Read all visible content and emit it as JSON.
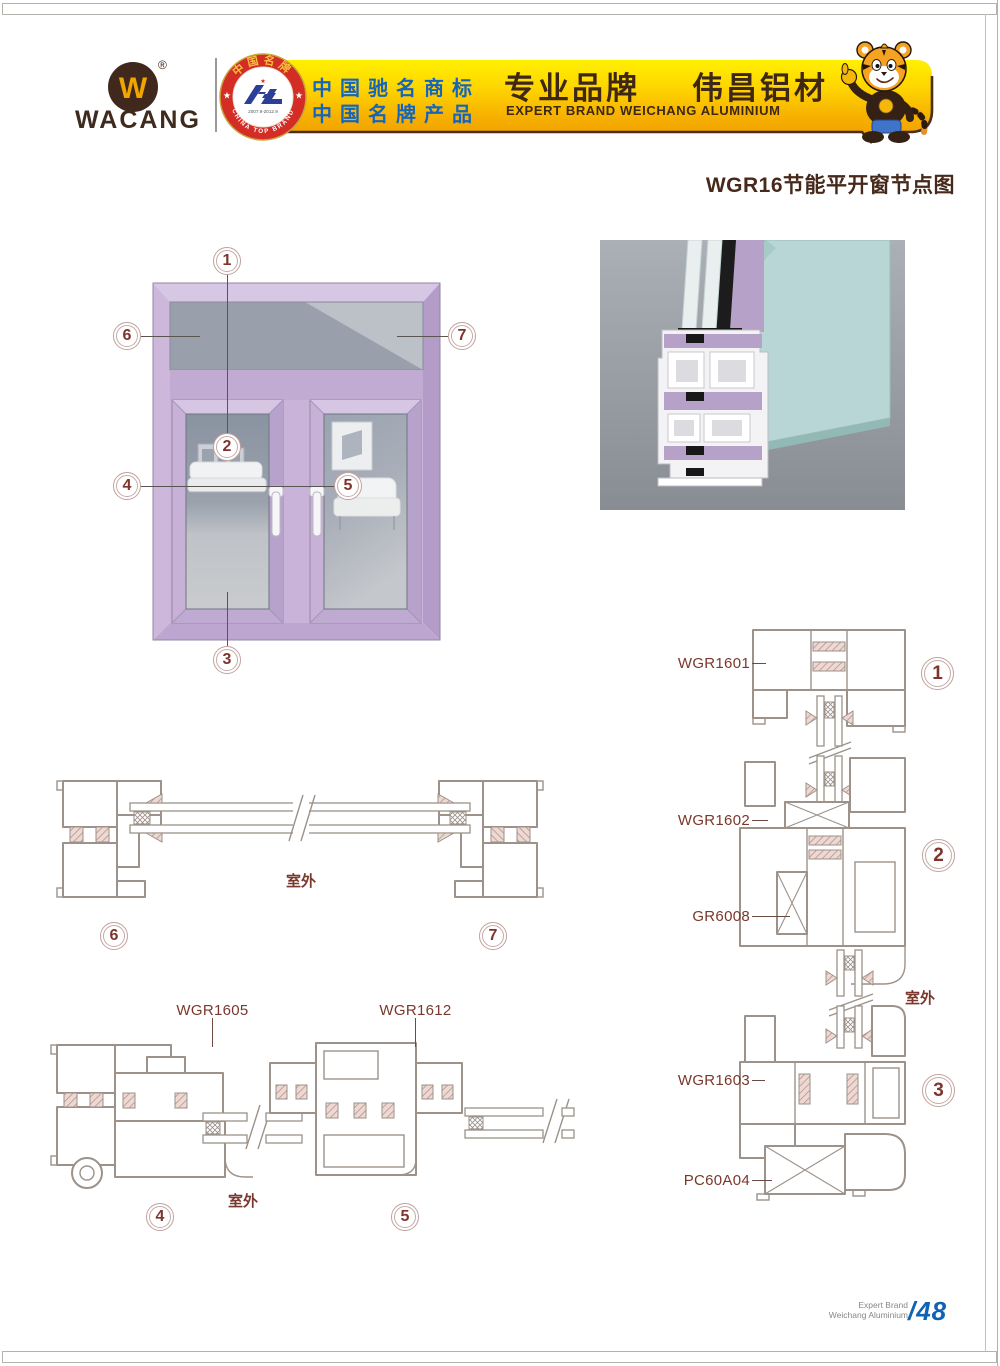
{
  "header": {
    "logo_letter": "W",
    "brand": "WACANG",
    "reg_mark": "®",
    "badge": {
      "arc_top": "中国名牌",
      "arc_bottom": "CHINA TOP BRAND",
      "years": "2007.9-2012.9"
    },
    "banner": {
      "cn_line1": "中国驰名商标",
      "cn_line2": "中国名牌产品",
      "slogan_cn": "专业品牌",
      "brand_cn": "伟昌铝材",
      "slogan_en": "EXPERT BRAND WEICHANG ALUMINIUM"
    }
  },
  "page_title": "WGR16节能平开窗节点图",
  "callouts": [
    "1",
    "2",
    "3",
    "4",
    "5",
    "6",
    "7"
  ],
  "labels": {
    "wgr1601": "WGR1601",
    "wgr1602": "WGR1602",
    "gr6008": "GR6008",
    "wgr1603": "WGR1603",
    "pc60a04": "PC60A04",
    "wgr1605": "WGR1605",
    "wgr1612": "WGR1612",
    "outdoor": "室外"
  },
  "footer": {
    "brand_line1": "Expert Brand",
    "brand_line2": "Weichang Aluminium",
    "page_number": "/48"
  },
  "colors": {
    "accent_brown": "#3f2716",
    "label_maroon": "#7a372c",
    "banner_yellow_top": "#fff000",
    "banner_yellow_bottom": "#ef9c00",
    "badge_red": "#d42d26",
    "emblem_blue": "#2b3f96",
    "page_blue": "#0f62b4",
    "window_purple": "#c9b3d8",
    "profile_line": "#9c9289",
    "render_teal": "#b7d6d5"
  }
}
